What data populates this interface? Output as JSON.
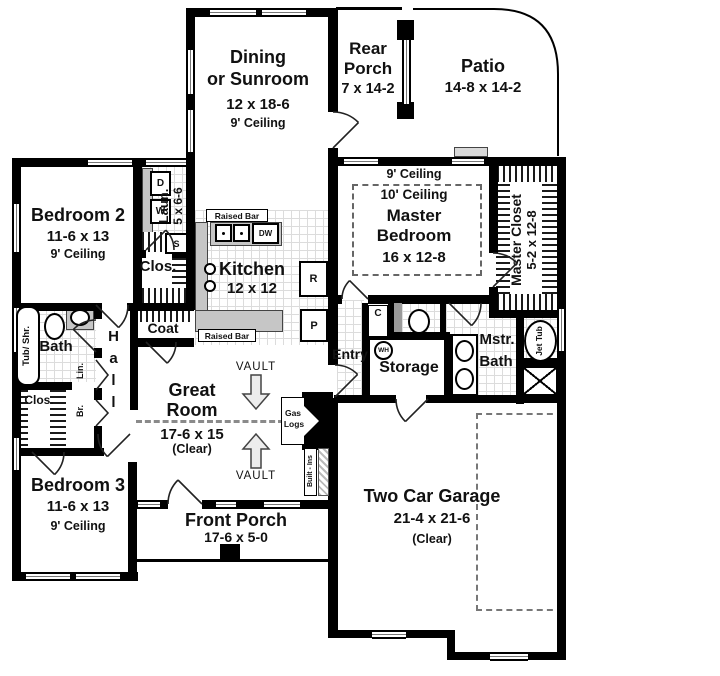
{
  "rooms": {
    "dining": {
      "line1": "Dining",
      "line2": "or Sunroom",
      "dims": "12 x 18-6",
      "ceiling": "9' Ceiling"
    },
    "rear_porch": {
      "line1": "Rear",
      "line2": "Porch",
      "dims": "7 x 14-2"
    },
    "patio": {
      "name": "Patio",
      "dims": "14-8 x 14-2"
    },
    "bedroom2": {
      "name": "Bedroom 2",
      "dims": "11-6 x 13",
      "ceiling": "9' Ceiling"
    },
    "laundry": {
      "name": "Laun.",
      "dims": "5 x 6-6"
    },
    "hall_closet": {
      "name": "Clos."
    },
    "kitchen": {
      "name": "Kitchen",
      "dims": "12 x 12",
      "raised_bar_top": "Raised Bar",
      "raised_bar_bottom": "Raised Bar"
    },
    "master_bedroom": {
      "ceiling_9": "9' Ceiling",
      "ceiling_10": "10' Ceiling",
      "line1": "Master",
      "line2": "Bedroom",
      "dims": "16 x 12-8"
    },
    "master_closet": {
      "name": "Master Closet",
      "dims": "5-2 x 12-8"
    },
    "bath": {
      "name": "Bath",
      "tub": "Tub/ Shr."
    },
    "hall": {
      "name": "Hall"
    },
    "coat": {
      "name": "Coat"
    },
    "linen": {
      "name": "Lin."
    },
    "broom": {
      "name": "Br."
    },
    "bed3_closet": {
      "name": "Clos."
    },
    "great_room": {
      "line1": "Great",
      "line2": "Room",
      "dims": "17-6 x 15",
      "clear": "(Clear)",
      "vault_upper": "VAULT",
      "vault_lower": "VAULT"
    },
    "fireplace": {
      "line1": "Gas",
      "line2": "Logs"
    },
    "built_ins": {
      "name": "Built - Ins"
    },
    "front_porch": {
      "name": "Front Porch",
      "dims": "17-6 x 5-0"
    },
    "entry": {
      "name": "Entry"
    },
    "storage": {
      "name": "Storage",
      "water_heater": "WH"
    },
    "master_bath": {
      "line1": "Mstr.",
      "line2": "Bath",
      "jet_tub": "Jet Tub"
    },
    "c_closet": {
      "name": "C"
    },
    "garage": {
      "name": "Two Car Garage",
      "dims": "21-4 x 21-6",
      "clear": "(Clear)"
    },
    "bedroom3": {
      "name": "Bedroom 3",
      "dims": "11-6 x 13",
      "ceiling": "9' Ceiling"
    }
  },
  "fixtures": {
    "dryer": "D",
    "washer": "W",
    "laundry_sink": "S",
    "dishwasher": "DW",
    "refrigerator": "R",
    "pantry": "P"
  },
  "colors": {
    "wall": "#000000",
    "counter": "#c6c6c6",
    "tile_line": "#d8d8d8",
    "hatch": "#1a1a1a",
    "dash": "#666666"
  }
}
